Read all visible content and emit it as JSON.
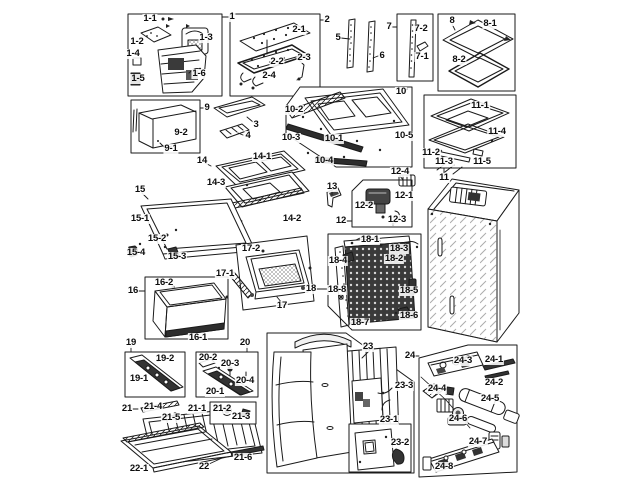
{
  "diagram": {
    "type": "exploded-parts-diagram",
    "subject": "refrigerator assembly",
    "background": "#ffffff",
    "line_color": "#1a1a1a",
    "label_color": "#0d0d0d"
  },
  "labels": [
    {
      "t": "1",
      "x": 232,
      "y": 17
    },
    {
      "t": "1-1",
      "x": 150,
      "y": 19
    },
    {
      "t": "1-2",
      "x": 137,
      "y": 42
    },
    {
      "t": "1-3",
      "x": 206,
      "y": 38
    },
    {
      "t": "1-4",
      "x": 133,
      "y": 54
    },
    {
      "t": "1-5",
      "x": 138,
      "y": 79
    },
    {
      "t": "1-6",
      "x": 199,
      "y": 74
    },
    {
      "t": "2",
      "x": 327,
      "y": 20
    },
    {
      "t": "2-1",
      "x": 299,
      "y": 30
    },
    {
      "t": "2-2",
      "x": 277,
      "y": 62
    },
    {
      "t": "2-3",
      "x": 304,
      "y": 58
    },
    {
      "t": "2-4",
      "x": 269,
      "y": 76
    },
    {
      "t": "5",
      "x": 338,
      "y": 38
    },
    {
      "t": "6",
      "x": 382,
      "y": 56
    },
    {
      "t": "7",
      "x": 389,
      "y": 27
    },
    {
      "t": "7-2",
      "x": 421,
      "y": 29
    },
    {
      "t": "7-1",
      "x": 422,
      "y": 57
    },
    {
      "t": "8",
      "x": 452,
      "y": 21
    },
    {
      "t": "8-1",
      "x": 490,
      "y": 24
    },
    {
      "t": "8-2",
      "x": 459,
      "y": 60
    },
    {
      "t": "9",
      "x": 207,
      "y": 108
    },
    {
      "t": "9-2",
      "x": 181,
      "y": 133
    },
    {
      "t": "9-1",
      "x": 171,
      "y": 149
    },
    {
      "t": "3",
      "x": 256,
      "y": 125
    },
    {
      "t": "4",
      "x": 248,
      "y": 136
    },
    {
      "t": "10",
      "x": 401,
      "y": 92
    },
    {
      "t": "10-2",
      "x": 294,
      "y": 110
    },
    {
      "t": "10-3",
      "x": 291,
      "y": 138
    },
    {
      "t": "10-1",
      "x": 334,
      "y": 139
    },
    {
      "t": "10-5",
      "x": 404,
      "y": 136
    },
    {
      "t": "10-4",
      "x": 324,
      "y": 161
    },
    {
      "t": "11-1",
      "x": 480,
      "y": 106
    },
    {
      "t": "11-4",
      "x": 497,
      "y": 132
    },
    {
      "t": "11-2",
      "x": 431,
      "y": 153
    },
    {
      "t": "11-3",
      "x": 444,
      "y": 162
    },
    {
      "t": "11-5",
      "x": 482,
      "y": 162
    },
    {
      "t": "11",
      "x": 444,
      "y": 178
    },
    {
      "t": "13",
      "x": 332,
      "y": 187
    },
    {
      "t": "12-4",
      "x": 400,
      "y": 172
    },
    {
      "t": "12-1",
      "x": 404,
      "y": 196
    },
    {
      "t": "12-2",
      "x": 364,
      "y": 206
    },
    {
      "t": "12-3",
      "x": 397,
      "y": 220
    },
    {
      "t": "12",
      "x": 341,
      "y": 221
    },
    {
      "t": "14",
      "x": 202,
      "y": 161
    },
    {
      "t": "14-1",
      "x": 262,
      "y": 157
    },
    {
      "t": "14-3",
      "x": 216,
      "y": 183
    },
    {
      "t": "14-2",
      "x": 292,
      "y": 219
    },
    {
      "t": "15",
      "x": 140,
      "y": 190
    },
    {
      "t": "15-1",
      "x": 140,
      "y": 219
    },
    {
      "t": "15-2",
      "x": 157,
      "y": 239
    },
    {
      "t": "15-4",
      "x": 136,
      "y": 253
    },
    {
      "t": "15-3",
      "x": 177,
      "y": 257
    },
    {
      "t": "16",
      "x": 133,
      "y": 291
    },
    {
      "t": "16-2",
      "x": 164,
      "y": 283
    },
    {
      "t": "16-1",
      "x": 198,
      "y": 338
    },
    {
      "t": "17-1",
      "x": 225,
      "y": 274
    },
    {
      "t": "17-2",
      "x": 251,
      "y": 249
    },
    {
      "t": "17",
      "x": 282,
      "y": 306
    },
    {
      "t": "18",
      "x": 311,
      "y": 289
    },
    {
      "t": "18-1",
      "x": 370,
      "y": 240
    },
    {
      "t": "18-3",
      "x": 399,
      "y": 249
    },
    {
      "t": "18-4",
      "x": 338,
      "y": 261
    },
    {
      "t": "18-2",
      "x": 394,
      "y": 259
    },
    {
      "t": "18-8",
      "x": 337,
      "y": 290
    },
    {
      "t": "18-5",
      "x": 409,
      "y": 291
    },
    {
      "t": "18-6",
      "x": 409,
      "y": 316
    },
    {
      "t": "18-7",
      "x": 360,
      "y": 323
    },
    {
      "t": "19",
      "x": 131,
      "y": 343
    },
    {
      "t": "19-2",
      "x": 165,
      "y": 359
    },
    {
      "t": "19-1",
      "x": 139,
      "y": 379
    },
    {
      "t": "20",
      "x": 245,
      "y": 343
    },
    {
      "t": "20-2",
      "x": 208,
      "y": 358
    },
    {
      "t": "20-3",
      "x": 230,
      "y": 364
    },
    {
      "t": "20-4",
      "x": 245,
      "y": 381
    },
    {
      "t": "20-1",
      "x": 215,
      "y": 392
    },
    {
      "t": "21",
      "x": 127,
      "y": 409
    },
    {
      "t": "21-4",
      "x": 153,
      "y": 407
    },
    {
      "t": "21-5",
      "x": 171,
      "y": 418
    },
    {
      "t": "21-1",
      "x": 197,
      "y": 409
    },
    {
      "t": "21-2",
      "x": 222,
      "y": 409
    },
    {
      "t": "21-3",
      "x": 241,
      "y": 417
    },
    {
      "t": "21-6",
      "x": 243,
      "y": 458
    },
    {
      "t": "22",
      "x": 204,
      "y": 467
    },
    {
      "t": "22-1",
      "x": 139,
      "y": 469
    },
    {
      "t": "23",
      "x": 368,
      "y": 347
    },
    {
      "t": "23-3",
      "x": 404,
      "y": 386
    },
    {
      "t": "23-1",
      "x": 389,
      "y": 420
    },
    {
      "t": "23-2",
      "x": 400,
      "y": 443
    },
    {
      "t": "24",
      "x": 410,
      "y": 356
    },
    {
      "t": "24-3",
      "x": 463,
      "y": 361
    },
    {
      "t": "24-1",
      "x": 494,
      "y": 360
    },
    {
      "t": "24-2",
      "x": 494,
      "y": 383
    },
    {
      "t": "24-4",
      "x": 437,
      "y": 389
    },
    {
      "t": "24-5",
      "x": 490,
      "y": 399
    },
    {
      "t": "24-6",
      "x": 458,
      "y": 419
    },
    {
      "t": "24-7",
      "x": 478,
      "y": 442
    },
    {
      "t": "24-8",
      "x": 444,
      "y": 467
    }
  ]
}
